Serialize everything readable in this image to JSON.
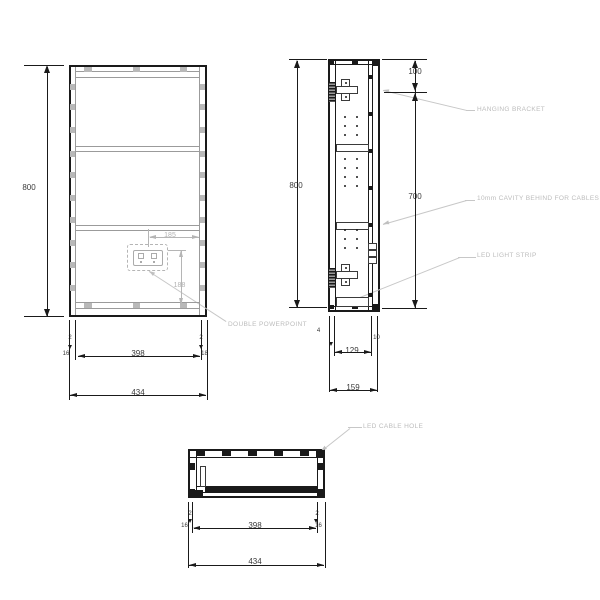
{
  "front_view": {
    "height": "800",
    "gap_left": "2",
    "panel_left": "16",
    "inner_width": "398",
    "gap_right": "2",
    "panel_right": "18",
    "total_width": "434",
    "socket_offset_x": "185",
    "socket_offset_y": "188"
  },
  "side_view": {
    "height": "800",
    "top_offset": "100",
    "lower_span": "700",
    "front_gap": "4",
    "inner_depth": "129",
    "cavity_depth": "10",
    "total_depth": "159"
  },
  "bottom_view": {
    "gap_left": "2",
    "panel_left": "16",
    "inner_width": "398",
    "gap_right": "2",
    "panel_right": "16",
    "total_width": "434"
  },
  "callouts": {
    "hanging_bracket": "HANGING BRACKET",
    "cavity": "10mm CAVITY BEHIND FOR CABLES",
    "led_strip": "LED LIGHT STRIP",
    "powerpoint": "DOUBLE POWERPOINT",
    "cable_hole": "LED CABLE HOLE"
  },
  "colors": {
    "ink": "#1a1a1a",
    "soft": "#9b9b9b",
    "faint": "#b5b5b5",
    "leader": "#c7c7c7"
  }
}
